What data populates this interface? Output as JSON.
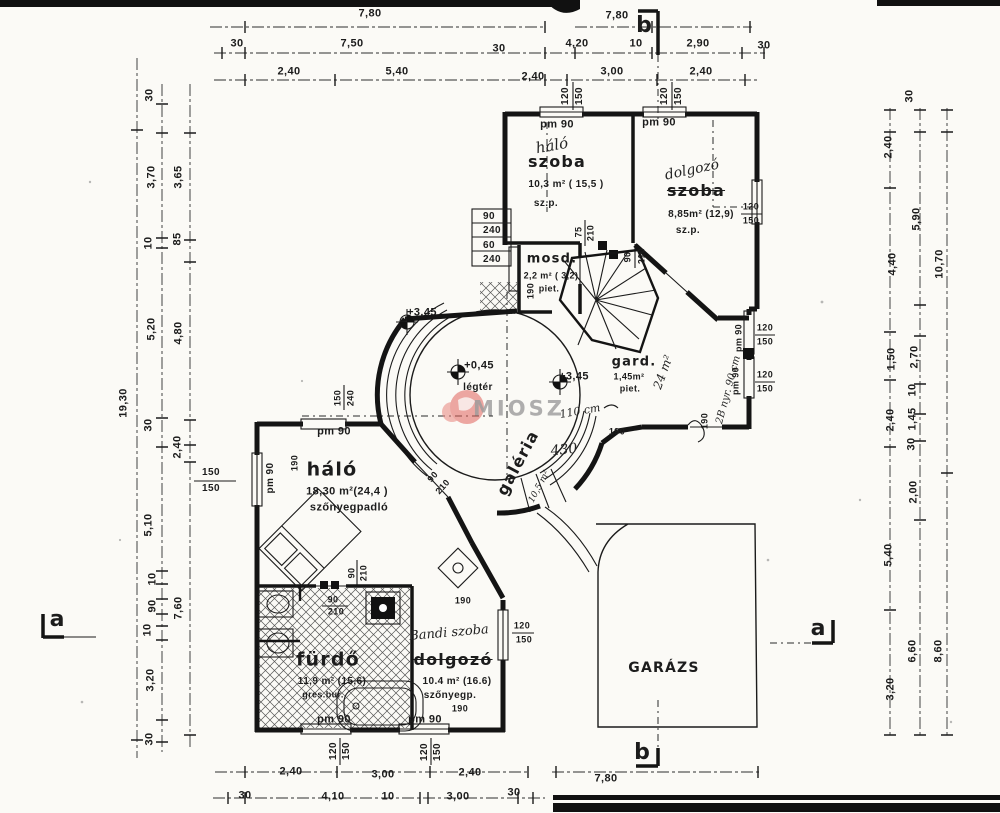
{
  "document": {
    "type": "architectural floor plan (emeleti alaprajz)",
    "language": "hu",
    "watermark": "MIOSZ",
    "section_markers": [
      "a",
      "b"
    ],
    "levels": [
      "+0,45",
      "+3,45"
    ],
    "colors": {
      "ink": "#1b1b1b",
      "paper": "#fbfaf6",
      "watermark_red": "#e0635c",
      "watermark_gray": "#9b9b9b"
    }
  },
  "rooms": [
    {
      "label": "szoba",
      "area": "10,3 m² ( 15,5 )",
      "floor": "sz.p.",
      "handwritten": "háló"
    },
    {
      "label": "szoba",
      "area": "8,85m² (12,9)",
      "floor": "sz.p.",
      "handwritten": "dolgozó"
    },
    {
      "label": "mosd.",
      "area": "2,2 m² ( 3,2)",
      "floor": "piet."
    },
    {
      "label": "gard.",
      "area": "1,45m²",
      "floor": "piet.",
      "handwritten": "24 m²"
    },
    {
      "label": "galéria",
      "area": "10,5 m²"
    },
    {
      "label": "háló",
      "area": "18,30 m²(24,4 )",
      "floor": "szőnyegpadló"
    },
    {
      "label": "fürdő",
      "area": "11,9 m² (15,6)",
      "floor": "gres.bur."
    },
    {
      "label": "dolgozó",
      "area": "10.4 m² (16.6)",
      "floor": "szőnyegp.",
      "handwritten": "Bandi szoba"
    },
    {
      "label": "GARÁZS"
    },
    {
      "label": "légtér"
    }
  ],
  "labels": [
    {
      "t": "7,80",
      "x": 370,
      "y": 14
    },
    {
      "t": "7,80",
      "x": 617,
      "y": 16
    },
    {
      "n": "section-letter-b-top",
      "t": "b",
      "x": 644,
      "y": 26,
      "c": "sec"
    },
    {
      "t": "30",
      "x": 237,
      "y": 44
    },
    {
      "t": "7,50",
      "x": 352,
      "y": 44
    },
    {
      "t": "30",
      "x": 499,
      "y": 49
    },
    {
      "t": "4,20",
      "x": 577,
      "y": 44
    },
    {
      "t": "10",
      "x": 636,
      "y": 44
    },
    {
      "t": "2,90",
      "x": 698,
      "y": 44
    },
    {
      "t": "30",
      "x": 764,
      "y": 46
    },
    {
      "t": "2,40",
      "x": 289,
      "y": 72
    },
    {
      "t": "5,40",
      "x": 397,
      "y": 72
    },
    {
      "t": "2,40",
      "x": 533,
      "y": 77
    },
    {
      "t": "3,00",
      "x": 612,
      "y": 72
    },
    {
      "t": "2,40",
      "x": 701,
      "y": 72
    },
    {
      "t": "120",
      "x": 566,
      "y": 96,
      "r": -90,
      "s": 10
    },
    {
      "t": "150",
      "x": 580,
      "y": 96,
      "r": -90,
      "s": 10
    },
    {
      "t": "120",
      "x": 665,
      "y": 96,
      "r": -90,
      "s": 10
    },
    {
      "t": "150",
      "x": 679,
      "y": 96,
      "r": -90,
      "s": 10
    },
    {
      "t": "120",
      "x": 334,
      "y": 751,
      "r": -90,
      "s": 10
    },
    {
      "t": "150",
      "x": 347,
      "y": 751,
      "r": -90,
      "s": 10
    },
    {
      "t": "120",
      "x": 425,
      "y": 752,
      "r": -90,
      "s": 10
    },
    {
      "t": "150",
      "x": 438,
      "y": 752,
      "r": -90,
      "s": 10
    },
    {
      "t": "2,40",
      "x": 291,
      "y": 772
    },
    {
      "t": "3,00",
      "x": 383,
      "y": 775
    },
    {
      "t": "2,40",
      "x": 470,
      "y": 773
    },
    {
      "t": "7,80",
      "x": 606,
      "y": 779
    },
    {
      "t": "30",
      "x": 245,
      "y": 796
    },
    {
      "t": "4,10",
      "x": 333,
      "y": 797
    },
    {
      "t": "10",
      "x": 388,
      "y": 797
    },
    {
      "t": "3,00",
      "x": 458,
      "y": 797
    },
    {
      "t": "30",
      "x": 514,
      "y": 793
    },
    {
      "n": "section-letter-b-bottom",
      "t": "b",
      "x": 642,
      "y": 753,
      "c": "sec"
    },
    {
      "t": "30",
      "x": 150,
      "y": 95,
      "r": -90
    },
    {
      "t": "3,70",
      "x": 152,
      "y": 177,
      "r": -90
    },
    {
      "t": "3,65",
      "x": 179,
      "y": 177,
      "r": -90
    },
    {
      "t": "10",
      "x": 149,
      "y": 243,
      "r": -90
    },
    {
      "t": "85",
      "x": 178,
      "y": 239,
      "r": -90
    },
    {
      "t": "5,20",
      "x": 152,
      "y": 329,
      "r": -90
    },
    {
      "t": "4,80",
      "x": 179,
      "y": 333,
      "r": -90
    },
    {
      "t": "19,30",
      "x": 124,
      "y": 403,
      "r": -90
    },
    {
      "t": "30",
      "x": 149,
      "y": 425,
      "r": -90
    },
    {
      "t": "2,40",
      "x": 178,
      "y": 447,
      "r": -90
    },
    {
      "t": "150",
      "x": 211,
      "y": 473,
      "s": 10
    },
    {
      "t": "150",
      "x": 211,
      "y": 489,
      "s": 10
    },
    {
      "t": "5,10",
      "x": 149,
      "y": 525,
      "r": -90
    },
    {
      "t": "10",
      "x": 153,
      "y": 579,
      "r": -90
    },
    {
      "t": "90",
      "x": 153,
      "y": 606,
      "r": -90
    },
    {
      "t": "7,60",
      "x": 179,
      "y": 608,
      "r": -90
    },
    {
      "t": "10",
      "x": 148,
      "y": 630,
      "r": -90
    },
    {
      "t": "3,20",
      "x": 151,
      "y": 680,
      "r": -90
    },
    {
      "t": "30",
      "x": 150,
      "y": 739,
      "r": -90
    },
    {
      "n": "section-letter-a-left",
      "t": "a",
      "x": 57,
      "y": 620,
      "c": "sec"
    },
    {
      "t": "30",
      "x": 910,
      "y": 96,
      "r": -90
    },
    {
      "t": "2,40",
      "x": 889,
      "y": 147,
      "r": -90
    },
    {
      "t": "5,90",
      "x": 917,
      "y": 219,
      "r": -90
    },
    {
      "t": "10,70",
      "x": 940,
      "y": 264,
      "r": -90
    },
    {
      "t": "4,40",
      "x": 893,
      "y": 264,
      "r": -90
    },
    {
      "t": "1,50",
      "x": 892,
      "y": 359,
      "r": -90
    },
    {
      "t": "2,70",
      "x": 915,
      "y": 357,
      "r": -90
    },
    {
      "t": "10",
      "x": 913,
      "y": 390,
      "r": -90
    },
    {
      "t": "2,40",
      "x": 891,
      "y": 420,
      "r": -90
    },
    {
      "t": "1,45",
      "x": 913,
      "y": 419,
      "r": -90
    },
    {
      "t": "30",
      "x": 912,
      "y": 444,
      "r": -90
    },
    {
      "t": "2,00",
      "x": 914,
      "y": 492,
      "r": -90
    },
    {
      "t": "5,40",
      "x": 889,
      "y": 555,
      "r": -90
    },
    {
      "t": "6,60",
      "x": 913,
      "y": 651,
      "r": -90
    },
    {
      "t": "8,60",
      "x": 939,
      "y": 651,
      "r": -90
    },
    {
      "t": "3,20",
      "x": 891,
      "y": 689,
      "r": -90
    },
    {
      "n": "section-letter-a-right",
      "t": "a",
      "x": 818,
      "y": 629,
      "c": "sec"
    },
    {
      "t": "pm 90",
      "x": 557,
      "y": 125,
      "s": 11
    },
    {
      "t": "pm 90",
      "x": 659,
      "y": 123,
      "s": 11
    },
    {
      "n": "handwritten-halo",
      "t": "háló",
      "x": 552,
      "y": 146,
      "c": "h",
      "s": 15,
      "r": -10
    },
    {
      "n": "room-szoba-1",
      "t": "szoba",
      "x": 557,
      "y": 162,
      "c": "b",
      "s": 16
    },
    {
      "t": "10,3 m² ( 15,5 )",
      "x": 566,
      "y": 185,
      "s": 10
    },
    {
      "t": "sz.p.",
      "x": 546,
      "y": 204,
      "s": 10
    },
    {
      "n": "handwritten-dolgozo",
      "t": "dolgozó",
      "x": 692,
      "y": 170,
      "c": "h",
      "s": 14,
      "r": -12
    },
    {
      "n": "room-szoba-2",
      "t": "szoba",
      "x": 696,
      "y": 191,
      "c": "bs",
      "s": 16
    },
    {
      "t": "8,85m² (12,9)",
      "x": 701,
      "y": 215,
      "s": 10
    },
    {
      "t": "sz.p.",
      "x": 688,
      "y": 231,
      "s": 10
    },
    {
      "t": "120",
      "x": 751,
      "y": 207,
      "s": 9
    },
    {
      "t": "150",
      "x": 751,
      "y": 221,
      "s": 9
    },
    {
      "t": "120",
      "x": 765,
      "y": 328,
      "s": 9
    },
    {
      "t": "150",
      "x": 765,
      "y": 342,
      "s": 9
    },
    {
      "t": "120",
      "x": 765,
      "y": 375,
      "s": 9
    },
    {
      "t": "150",
      "x": 765,
      "y": 389,
      "s": 9
    },
    {
      "t": "pm 90",
      "x": 739,
      "y": 338,
      "r": -90,
      "s": 9
    },
    {
      "t": "pm 90",
      "x": 736,
      "y": 381,
      "r": -90,
      "s": 9
    },
    {
      "n": "handwritten-wall-note",
      "t": "2B nyr. 90 cm",
      "x": 729,
      "y": 390,
      "r": -75,
      "c": "h",
      "s": 10
    },
    {
      "t": "90",
      "x": 489,
      "y": 217,
      "s": 10
    },
    {
      "t": "240",
      "x": 492,
      "y": 231,
      "s": 10
    },
    {
      "t": "60",
      "x": 489,
      "y": 246,
      "s": 10
    },
    {
      "t": "240",
      "x": 492,
      "y": 260,
      "s": 10
    },
    {
      "t": "75",
      "x": 579,
      "y": 232,
      "r": -90,
      "s": 9
    },
    {
      "t": "210",
      "x": 591,
      "y": 233,
      "r": -90,
      "s": 9
    },
    {
      "n": "room-mosdo",
      "t": "mosd.",
      "x": 552,
      "y": 259,
      "c": "b",
      "s": 13
    },
    {
      "t": "2,2 m² ( 3,2)",
      "x": 551,
      "y": 276,
      "s": 9
    },
    {
      "t": "piet.",
      "x": 549,
      "y": 289,
      "s": 9
    },
    {
      "t": "190",
      "x": 531,
      "y": 291,
      "r": -90,
      "s": 9
    },
    {
      "t": "90",
      "x": 628,
      "y": 257,
      "r": -90,
      "s": 9
    },
    {
      "t": "210",
      "x": 642,
      "y": 256,
      "r": -90,
      "s": 9
    },
    {
      "n": "room-gard",
      "t": "gard.",
      "x": 634,
      "y": 362,
      "c": "b",
      "s": 13
    },
    {
      "t": "1,45m²",
      "x": 629,
      "y": 377,
      "s": 9
    },
    {
      "t": "piet.",
      "x": 630,
      "y": 389,
      "s": 9
    },
    {
      "n": "handwritten-24m2",
      "t": "24 m²",
      "x": 663,
      "y": 372,
      "r": -70,
      "c": "h",
      "s": 12
    },
    {
      "t": "+3,45",
      "x": 574,
      "y": 377,
      "s": 11
    },
    {
      "t": "+3,45",
      "x": 422,
      "y": 313,
      "s": 11
    },
    {
      "t": "+0,45",
      "x": 479,
      "y": 366,
      "s": 11
    },
    {
      "t": "légtér",
      "x": 478,
      "y": 388,
      "s": 10
    },
    {
      "n": "room-galeria",
      "t": "galéria",
      "x": 518,
      "y": 463,
      "r": -62,
      "c": "b",
      "s": 16
    },
    {
      "n": "galeria-area",
      "t": "10,5 m²",
      "x": 540,
      "y": 487,
      "r": -62,
      "c": "h",
      "s": 9
    },
    {
      "n": "handwritten-110cm",
      "t": "110 cm",
      "x": 580,
      "y": 411,
      "r": -10,
      "c": "h",
      "s": 11
    },
    {
      "n": "handwritten-430",
      "t": "430",
      "x": 564,
      "y": 450,
      "r": -6,
      "c": "h",
      "s": 14
    },
    {
      "t": "190",
      "x": 617,
      "y": 432,
      "s": 9
    },
    {
      "t": "190",
      "x": 705,
      "y": 421,
      "r": -90,
      "s": 9
    },
    {
      "t": "150",
      "x": 338,
      "y": 398,
      "r": -90,
      "s": 9
    },
    {
      "t": "240",
      "x": 351,
      "y": 398,
      "r": -90,
      "s": 9
    },
    {
      "t": "pm 90",
      "x": 334,
      "y": 432,
      "s": 11
    },
    {
      "t": "190",
      "x": 295,
      "y": 463,
      "r": -90,
      "s": 9
    },
    {
      "t": "pm 90",
      "x": 271,
      "y": 478,
      "r": -90,
      "s": 10
    },
    {
      "n": "room-halo",
      "t": "háló",
      "x": 332,
      "y": 470,
      "c": "b",
      "s": 19
    },
    {
      "t": "18,30 m²(24,4 )",
      "x": 347,
      "y": 492,
      "s": 11
    },
    {
      "t": "szőnyegpadló",
      "x": 349,
      "y": 508,
      "s": 11
    },
    {
      "t": "90",
      "x": 433,
      "y": 477,
      "r": -48,
      "s": 9
    },
    {
      "t": "210",
      "x": 443,
      "y": 487,
      "r": -48,
      "s": 9
    },
    {
      "t": "90",
      "x": 352,
      "y": 573,
      "r": -90,
      "s": 9
    },
    {
      "t": "210",
      "x": 364,
      "y": 573,
      "r": -90,
      "s": 9
    },
    {
      "t": "90",
      "x": 333,
      "y": 600,
      "s": 9
    },
    {
      "t": "210",
      "x": 336,
      "y": 612,
      "s": 9
    },
    {
      "n": "room-furdo",
      "t": "fürdő",
      "x": 328,
      "y": 660,
      "c": "b",
      "s": 19
    },
    {
      "t": "11,9 m² (15,6)",
      "x": 332,
      "y": 682,
      "s": 10
    },
    {
      "t": "gres.bur.",
      "x": 323,
      "y": 695,
      "s": 9
    },
    {
      "t": "pm 90",
      "x": 334,
      "y": 720,
      "s": 11
    },
    {
      "n": "handwritten-bandi",
      "t": "Bandi szoba",
      "x": 449,
      "y": 633,
      "r": -5,
      "c": "h",
      "s": 13
    },
    {
      "n": "room-dolgozo",
      "t": "dolgozó",
      "x": 453,
      "y": 660,
      "c": "bs",
      "s": 16
    },
    {
      "t": "10.4 m² (16.6)",
      "x": 457,
      "y": 682,
      "s": 10
    },
    {
      "t": "szőnyegp.",
      "x": 450,
      "y": 696,
      "s": 10
    },
    {
      "t": "190",
      "x": 460,
      "y": 709,
      "s": 9
    },
    {
      "t": "pm 90",
      "x": 425,
      "y": 720,
      "s": 11
    },
    {
      "t": "190",
      "x": 463,
      "y": 601,
      "s": 9
    },
    {
      "t": "120",
      "x": 522,
      "y": 626,
      "s": 9
    },
    {
      "t": "150",
      "x": 524,
      "y": 640,
      "s": 9
    },
    {
      "n": "room-garazs",
      "t": "GARÁZS",
      "x": 664,
      "y": 668,
      "c": "b",
      "s": 14
    },
    {
      "n": "watermark-text",
      "t": "MIOSZ",
      "x": 519,
      "y": 409,
      "c": "w"
    }
  ]
}
